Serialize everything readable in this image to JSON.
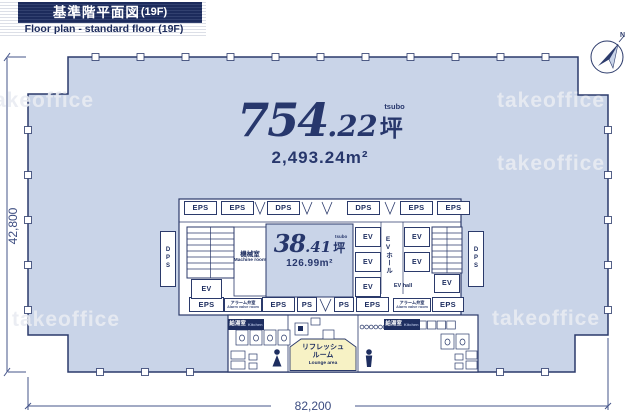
{
  "header": {
    "title_jp": "基準階平面図",
    "title_floor": "(19F)",
    "subtitle": "Floor plan - standard floor (19F)"
  },
  "compass": {
    "north": "N"
  },
  "watermark": {
    "text": "takeoffice"
  },
  "dimensions": {
    "width": "82,200",
    "height": "42,800"
  },
  "main_area": {
    "value": "754",
    "decimal": ".22",
    "unit": "坪",
    "unit_en": "tsubo",
    "sqm": "2,493.24",
    "sqm_unit": "m²"
  },
  "core_area": {
    "value": "38",
    "decimal": ".41",
    "unit": "坪",
    "unit_en": "tsubo",
    "sqm": "126.99",
    "sqm_unit": "m²"
  },
  "labels": {
    "eps": "EPS",
    "dps": "DPS",
    "ps": "PS",
    "ev": "EV",
    "machine_jp": "機械室",
    "machine_en": "Machine room",
    "ev_hall_jp": "EVホール",
    "ev_hall_en": "EV hall",
    "alarm_jp": "アラーム弁室",
    "alarm_en": "Alarm valve room",
    "kitchen_jp": "給湯室",
    "kitchen_en": "Kitchen",
    "lounge_jp1": "リフレッシュ",
    "lounge_jp2": "ルーム",
    "lounge_en": "Lounge area"
  }
}
